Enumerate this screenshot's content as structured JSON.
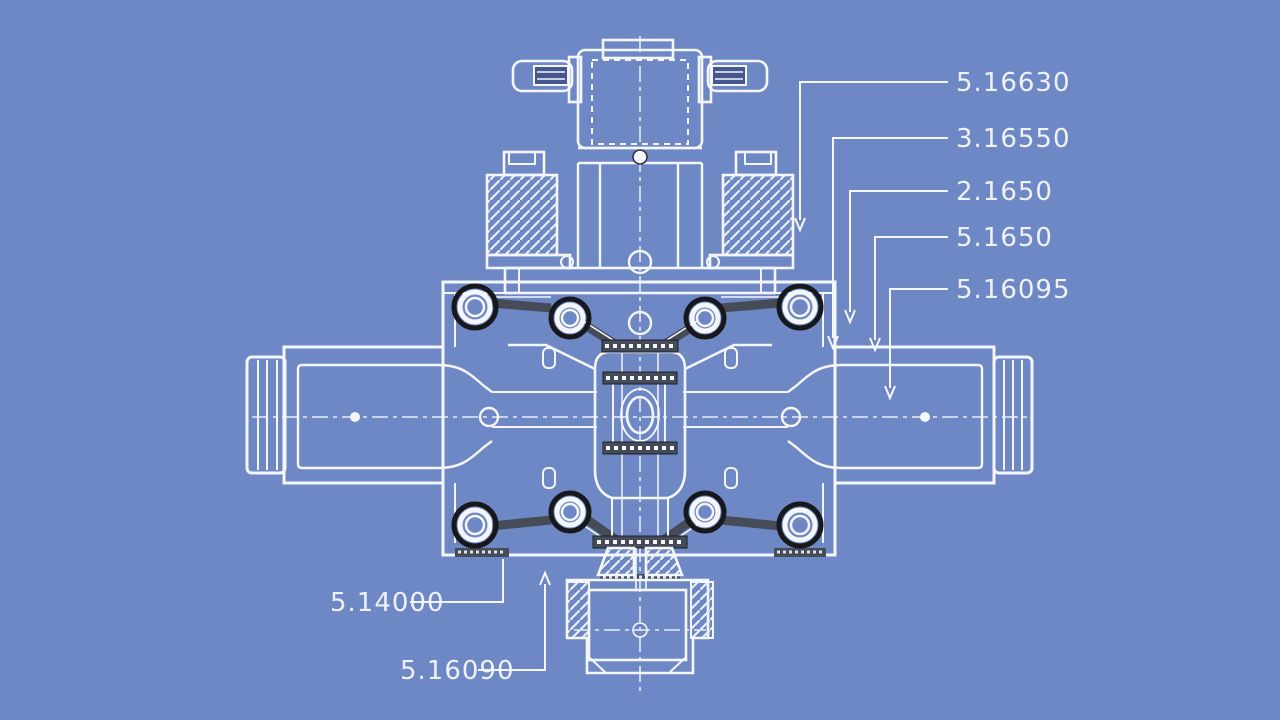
{
  "drawing": {
    "type": "blueprint-cross-section",
    "subject": "valve-assembly",
    "colors": {
      "background": "#6e88c5",
      "line": "#f4f6f9",
      "dark_ring": "#17181c",
      "gasket_band": "#454b57",
      "wing_fill": "#44578f"
    }
  },
  "callouts": {
    "right": [
      {
        "id": "r1",
        "label": "5.16630"
      },
      {
        "id": "r2",
        "label": "3.16550"
      },
      {
        "id": "r3",
        "label": "2.1650"
      },
      {
        "id": "r4",
        "label": "5.1650"
      },
      {
        "id": "r5",
        "label": "5.16095"
      }
    ],
    "bottom": [
      {
        "id": "b1",
        "label": "5.14000"
      },
      {
        "id": "b2",
        "label": "5.16090"
      }
    ]
  }
}
